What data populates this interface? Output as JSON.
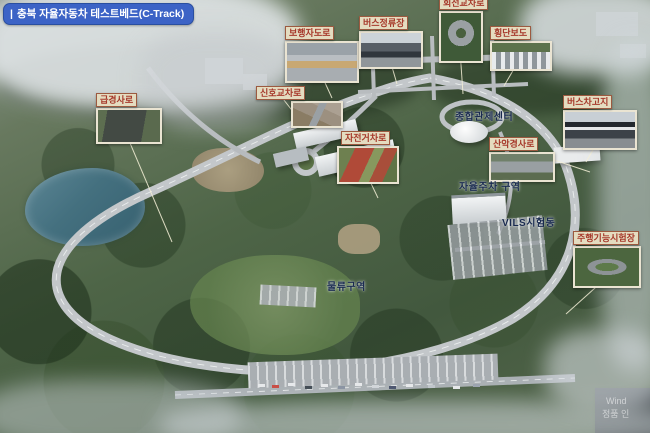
{
  "title": {
    "bar": "|",
    "text": "충북 자율자동차 테스트베드(C-Track)"
  },
  "callouts": [
    {
      "label": "급경사로"
    },
    {
      "label": "보행자도로"
    },
    {
      "label": "버스정류장"
    },
    {
      "label": "회전교차로"
    },
    {
      "label": "횡단보도"
    },
    {
      "label": "신호교차로"
    },
    {
      "label": "자전거차로"
    },
    {
      "label": "산악경사로"
    },
    {
      "label": "버스차고지"
    },
    {
      "label": "주행기능시험장"
    }
  ],
  "area_labels": [
    {
      "text": "종합관제센터"
    },
    {
      "text": "자율주차 구역"
    },
    {
      "text": "VILS시험동"
    },
    {
      "text": "물류구역"
    }
  ],
  "watermark": {
    "line1": "Wind",
    "line2": "정품 인"
  },
  "colors": {
    "title_bg": "#3c63c6",
    "callout_label_red": "#a6382a",
    "callout_tag_bg": "#e4dcc0",
    "map_label_navy": "#18294e",
    "lake": "#44707f",
    "road": "#c3c7ca"
  }
}
